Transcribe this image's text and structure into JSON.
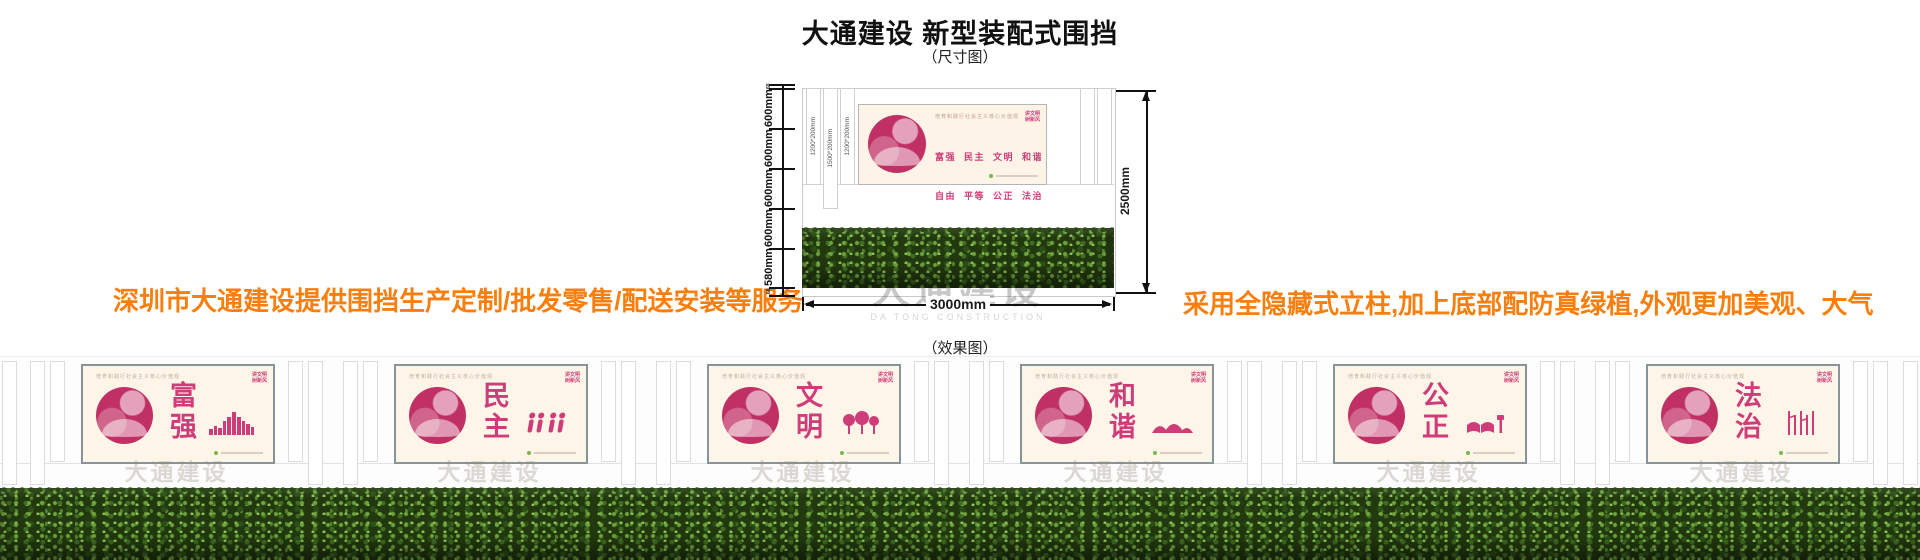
{
  "page": {
    "title": "大通建设 新型装配式围挡",
    "size_label": "（尺寸图）",
    "effect_label": "（效果图）",
    "left_tagline": "深圳市大通建设提供围挡生产定制/批发零售/配送安装等服务",
    "right_tagline": "采用全隐藏式立柱,加上底部配防真绿植,外观更加美观、大气"
  },
  "colors": {
    "tagline_orange": "#f87e0e",
    "poster_cream": "#fdf5e8",
    "hedge_green": "#22380f"
  },
  "watermark": {
    "cn": "大通建设",
    "en": "DA TONG CONSTRUCTION"
  },
  "diagram": {
    "left_dims": [
      "60",
      "600mm",
      "600mm",
      "600mm",
      "600mm",
      "580mm",
      "60"
    ],
    "right_dim": "2500mm",
    "bottom_dim": "3000mm",
    "slat_labels": [
      "1200*200mm",
      "1500*200mm",
      "1200*200mm"
    ]
  },
  "poster_common": {
    "header": "培育和践行社会主义核心价值观",
    "badge_line1": "讲文明",
    "badge_line2": "树新风"
  },
  "core_poster": {
    "accent": "#ce3d7a",
    "circle": "#c13064",
    "rows": [
      "富强  民主  文明  和谐",
      "自由  平等  公正  法治",
      "爱国  敬业  诚信  友善"
    ]
  },
  "panels": [
    {
      "word": "富强",
      "accent": "#c83a50",
      "circle": "#b82a48"
    },
    {
      "word": "民主",
      "accent": "#3f86ba",
      "circle": "#2f77ad"
    },
    {
      "word": "文明",
      "accent": "#e3951d",
      "circle": "#d98812"
    },
    {
      "word": "和谐",
      "accent": "#2b8d7b",
      "circle": "#1d806f"
    },
    {
      "word": "公正",
      "accent": "#d4691c",
      "circle": "#c35a10"
    },
    {
      "word": "法治",
      "accent": "#2e9e4c",
      "circle": "#1f8f3f"
    }
  ]
}
